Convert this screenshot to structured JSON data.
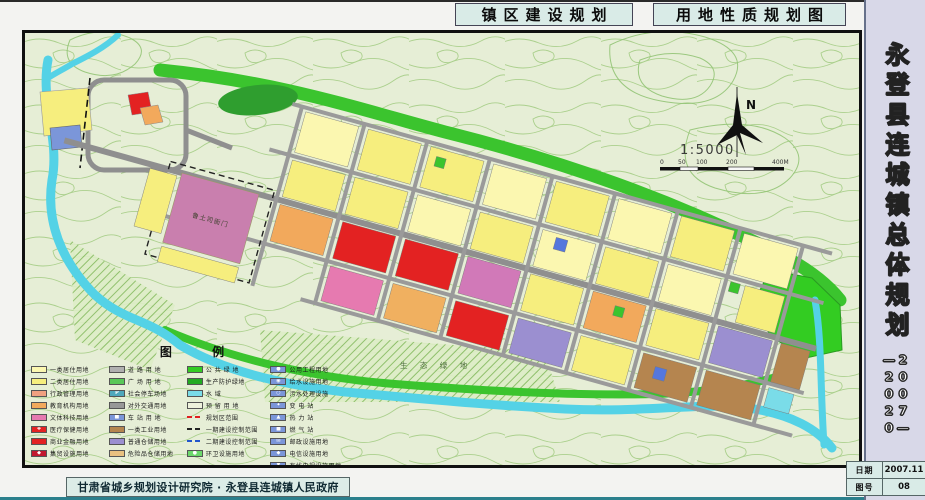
{
  "page": {
    "title_left": "镇区建设规划",
    "title_right": "用地性质规划图",
    "credit": "甘肃省城乡规划设计研究院 · 永登县连城镇人民政府"
  },
  "sidebar": {
    "title": "永登县连城镇总体规划",
    "period": "2007—\n—2020",
    "info": [
      {
        "label": "日期",
        "value": "2007.11"
      },
      {
        "label": "图号",
        "value": "08"
      }
    ]
  },
  "map": {
    "north_label": "N",
    "scale_text": "1:5000",
    "scale_ticks": [
      "0",
      "50",
      "100",
      "200",
      "400M"
    ],
    "labels": {
      "heritage": "鲁土司衙门",
      "eco_green": "生 态 绿 地"
    }
  },
  "legend": {
    "title": "图  例",
    "columns": [
      [
        {
          "label": "一类居住用地",
          "color": "#fbf7b0",
          "kind": "fill"
        },
        {
          "label": "二类居住用地",
          "color": "#f6ee7e",
          "kind": "fill"
        },
        {
          "label": "行政管理用地",
          "color": "#f0a080",
          "kind": "fill"
        },
        {
          "label": "教育机构用地",
          "color": "#f2a95c",
          "kind": "fill"
        },
        {
          "label": "文体科技用地",
          "color": "#e67ab0",
          "kind": "fill"
        },
        {
          "label": "医疗保健用地",
          "color": "#e32222",
          "kind": "fill",
          "symbol": "✚"
        },
        {
          "label": "商业金融用地",
          "color": "#e32222",
          "kind": "fill"
        },
        {
          "label": "集贸设施用地",
          "color": "#c2182e",
          "kind": "fill",
          "symbol": "◆"
        }
      ],
      [
        {
          "label": "道 路 用 地",
          "color": "#b0b0b0",
          "kind": "fill"
        },
        {
          "label": "广 场 用 地",
          "color": "#58c858",
          "kind": "fill"
        },
        {
          "label": "社会停车场地",
          "color": "#4fa8bc",
          "kind": "fill",
          "symbol": "P"
        },
        {
          "label": "对外交通用地",
          "color": "#989898",
          "kind": "fill"
        },
        {
          "label": "车 站 用 地",
          "color": "#7b96d9",
          "kind": "fill",
          "symbol": "■"
        },
        {
          "label": "一类工业用地",
          "color": "#b5854f",
          "kind": "fill"
        },
        {
          "label": "普通仓储用地",
          "color": "#9b8fd0",
          "kind": "fill"
        },
        {
          "label": "危险品仓储用地",
          "color": "#e8c080",
          "kind": "fill"
        }
      ],
      [
        {
          "label": "公 共 绿 地",
          "color": "#33cc22",
          "kind": "fill"
        },
        {
          "label": "生产防护绿地",
          "color": "#22aa22",
          "kind": "fill"
        },
        {
          "label": "水    域",
          "color": "#7adce8",
          "kind": "fill"
        },
        {
          "label": "预 留 用 地",
          "color": "#eef2dc",
          "kind": "fill"
        },
        {
          "label": "规划区范围",
          "color": "#e02020",
          "kind": "line"
        },
        {
          "label": "一期建设控制范围",
          "color": "#222222",
          "kind": "line"
        },
        {
          "label": "二期建设控制范围",
          "color": "#2255cc",
          "kind": "line"
        },
        {
          "label": "环卫设施用地",
          "color": "#6cd86c",
          "kind": "fill",
          "symbol": "●"
        }
      ],
      [
        {
          "label": "公用工程用地",
          "color": "#7b96d9",
          "kind": "fill",
          "symbol": "●"
        },
        {
          "label": "给水设施用地",
          "color": "#7b96d9",
          "kind": "fill",
          "symbol": "◉"
        },
        {
          "label": "污水处理设施",
          "color": "#7b96d9",
          "kind": "fill",
          "symbol": "○"
        },
        {
          "label": "变  电  站",
          "color": "#7b96d9",
          "kind": "fill",
          "symbol": "✦"
        },
        {
          "label": "热  力  站",
          "color": "#7b96d9",
          "kind": "fill",
          "symbol": "▲"
        },
        {
          "label": "燃  气  站",
          "color": "#7b96d9",
          "kind": "fill",
          "symbol": "■"
        },
        {
          "label": "邮政设施用地",
          "color": "#7b96d9",
          "kind": "fill",
          "symbol": "✉"
        },
        {
          "label": "电信设施用地",
          "color": "#7b96d9",
          "kind": "fill",
          "symbol": "◆"
        },
        {
          "label": "有线电视设施用地",
          "color": "#7b96d9",
          "kind": "fill",
          "symbol": "▼"
        }
      ]
    ]
  },
  "colors": {
    "map_bg": "#e6eed6",
    "contour": "#9cc87a",
    "water": "#54d2e6",
    "green_band": "#3bc42e",
    "residential_1": "#fbf7b0",
    "residential_2": "#f6ee7e",
    "commercial_red": "#e32222",
    "education_orange": "#f2a95c",
    "culture_pink": "#e67ab0",
    "heritage_mauve": "#c97fae",
    "industry_brown": "#b5854f",
    "warehouse_purple": "#9b8fd0",
    "road_gray": "#9a9a9a",
    "utility_blue": "#7b96d9",
    "title_box_bg": "#d9ebe7",
    "sidebar_bg": "#d8d8e8",
    "bottom_rule": "#2b7f8c"
  }
}
